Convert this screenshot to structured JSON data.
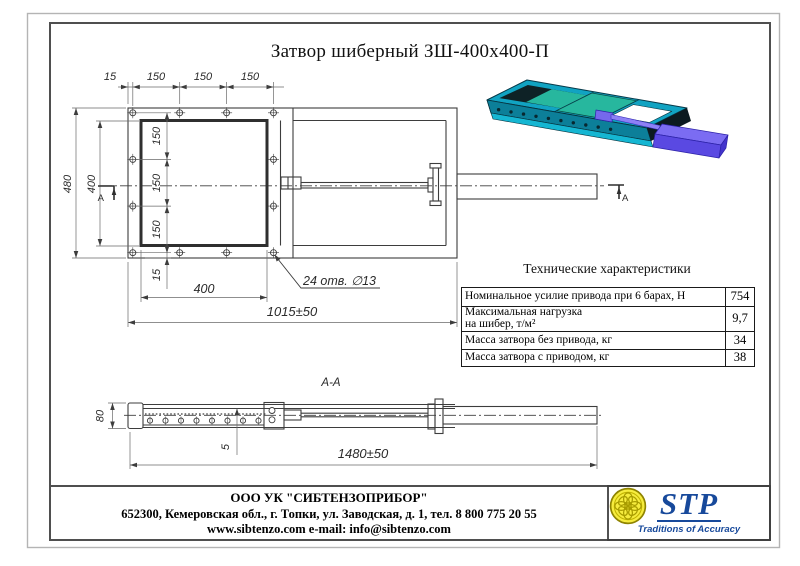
{
  "title": "Затвор шиберный ЗШ-400х400-П",
  "front_view": {
    "dim_top_offset": "15",
    "dim_top_1": "150",
    "dim_top_2": "150",
    "dim_top_3": "150",
    "dim_left_outer": "480",
    "dim_left_inner": "400",
    "dim_side_1": "150",
    "dim_side_2": "150",
    "dim_side_3": "150",
    "dim_bottom_offset": "15",
    "dim_opening_width": "400",
    "dim_overall_length": "1015±50",
    "holes_note": "24 отв. ∅13",
    "section_mark": "А"
  },
  "section_view": {
    "label": "А-А",
    "dim_height": "80",
    "dim_plate": "5",
    "dim_length": "1480±50"
  },
  "tech": {
    "title": "Технические характеристики",
    "rows": [
      {
        "label": "Номинальное усилие привода при 6 барах, Н",
        "label2": "",
        "value": "754"
      },
      {
        "label": "Максимальная нагрузка",
        "label2": "на шибер, т/м²",
        "value": "9,7"
      },
      {
        "label": "Масса затвора без привода, кг",
        "label2": "",
        "value": "34"
      },
      {
        "label": "Масса затвора с приводом, кг",
        "label2": "",
        "value": "38"
      }
    ]
  },
  "footer": {
    "company": "ООО УК \"СИБТЕНЗОПРИБОР\"",
    "address": "652300, Кемеровская обл., г. Топки, ул. Заводская, д. 1, тел. 8 800 775 20 55",
    "contacts": "www.sibtenzo.com e-mail: info@sibtenzo.com"
  },
  "logo": {
    "abbr": "STP",
    "tagline": "Traditions of Accuracy"
  },
  "colors": {
    "line": "#3d3d3d",
    "accent_blue": "#17499b",
    "emblem_yellow": "#f6ec3e",
    "body_teal": "#11a3c2",
    "gate_green": "#27b79e",
    "actuator_purple": "#5a49e2"
  }
}
